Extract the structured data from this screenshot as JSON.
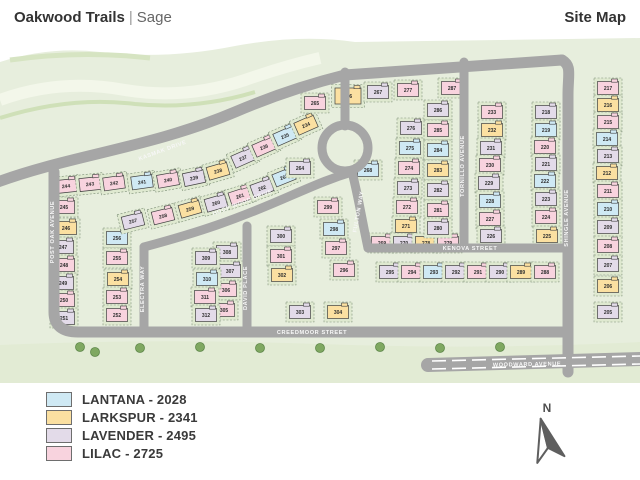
{
  "header": {
    "community": "Oakwood Trails",
    "pipe": "|",
    "collection": "Sage",
    "page_title": "Site Map"
  },
  "legend": {
    "items": [
      {
        "plan": "lantana",
        "label": "LANTANA - 2028",
        "color": "#cfe9f4"
      },
      {
        "plan": "larkspur",
        "label": "LARKSPUR - 2341",
        "color": "#fbe0a1"
      },
      {
        "plan": "lavender",
        "label": "LAVENDER - 2495",
        "color": "#e3dbe9"
      },
      {
        "plan": "lilac",
        "label": "LILAC - 2725",
        "color": "#f8d3de"
      }
    ]
  },
  "north_arrow": {
    "label": "N",
    "color": "#5f5f5f"
  },
  "map": {
    "plan_colors": {
      "lantana": "#cfe9f4",
      "larkspur": "#fbe0a1",
      "lavender": "#e3dbe9",
      "lilac": "#f8d3de"
    },
    "base_green": "#e7eedd",
    "parcel_green": "#dfe9d0",
    "road_gray": "#a6a6a6",
    "tree_green": "#7fa861",
    "streets": [
      {
        "name": "KASMAK DRIVE",
        "x": 163,
        "y": 152,
        "rot": -20
      },
      {
        "name": "POST OAK AVENUE",
        "x": 54,
        "y": 232,
        "rot": -90
      },
      {
        "name": "ELECTRA WAY",
        "x": 144,
        "y": 289,
        "rot": -90
      },
      {
        "name": "DAVID PLACE",
        "x": 247,
        "y": 288,
        "rot": -90
      },
      {
        "name": "HOOP WOOD DRIVE",
        "x": 243,
        "y": 204,
        "rot": -21
      },
      {
        "name": "FULTON WAY",
        "x": 360,
        "y": 212,
        "rot": -80
      },
      {
        "name": "TORNILLO AVENUE",
        "x": 464,
        "y": 166,
        "rot": -90
      },
      {
        "name": "SHINGLE AVENUE",
        "x": 568,
        "y": 218,
        "rot": -90
      },
      {
        "name": "KENOVA STREET",
        "x": 470,
        "y": 250,
        "rot": 0
      },
      {
        "name": "CREEDMOOR STREET",
        "x": 312,
        "y": 334,
        "rot": 0
      },
      {
        "name": "WOODWARD AVENUE",
        "x": 527,
        "y": 366,
        "rot": -1
      }
    ],
    "lots": [
      {
        "n": "244",
        "p": "lilac",
        "x": 66,
        "y": 186,
        "r": -6
      },
      {
        "n": "243",
        "p": "lilac",
        "x": 90,
        "y": 184,
        "r": -6
      },
      {
        "n": "242",
        "p": "lilac",
        "x": 114,
        "y": 183,
        "r": -8
      },
      {
        "n": "241",
        "p": "lantana",
        "x": 142,
        "y": 182,
        "r": -8
      },
      {
        "n": "240",
        "p": "lilac",
        "x": 168,
        "y": 180,
        "r": -10
      },
      {
        "n": "239",
        "p": "lavender",
        "x": 194,
        "y": 178,
        "r": -12
      },
      {
        "n": "238",
        "p": "larkspur",
        "x": 218,
        "y": 171,
        "r": -16
      },
      {
        "n": "237",
        "p": "lavender",
        "x": 243,
        "y": 158,
        "r": -24
      },
      {
        "n": "236",
        "p": "lilac",
        "x": 264,
        "y": 147,
        "r": -24
      },
      {
        "n": "235",
        "p": "lantana",
        "x": 285,
        "y": 136,
        "r": -24
      },
      {
        "n": "234",
        "p": "larkspur",
        "x": 306,
        "y": 125,
        "r": -24
      },
      {
        "n": "245",
        "p": "lilac",
        "x": 64,
        "y": 207
      },
      {
        "n": "246",
        "p": "larkspur",
        "x": 66,
        "y": 228
      },
      {
        "n": "247",
        "p": "lavender",
        "x": 63,
        "y": 247
      },
      {
        "n": "248",
        "p": "lilac",
        "x": 64,
        "y": 265
      },
      {
        "n": "249",
        "p": "lavender",
        "x": 63,
        "y": 283
      },
      {
        "n": "250",
        "p": "lilac",
        "x": 64,
        "y": 300
      },
      {
        "n": "251",
        "p": "lavender",
        "x": 64,
        "y": 318
      },
      {
        "n": "256",
        "p": "lantana",
        "x": 117,
        "y": 238
      },
      {
        "n": "255",
        "p": "lilac",
        "x": 117,
        "y": 258
      },
      {
        "n": "254",
        "p": "larkspur",
        "x": 118,
        "y": 279
      },
      {
        "n": "253",
        "p": "lilac",
        "x": 117,
        "y": 297
      },
      {
        "n": "252",
        "p": "lilac",
        "x": 117,
        "y": 315
      },
      {
        "n": "257",
        "p": "lavender",
        "x": 133,
        "y": 221,
        "r": -14
      },
      {
        "n": "258",
        "p": "lilac",
        "x": 163,
        "y": 216,
        "r": -14
      },
      {
        "n": "259",
        "p": "larkspur",
        "x": 190,
        "y": 209,
        "r": -16
      },
      {
        "n": "260",
        "p": "lavender",
        "x": 216,
        "y": 203,
        "r": -16
      },
      {
        "n": "261",
        "p": "lilac",
        "x": 240,
        "y": 196,
        "r": -18
      },
      {
        "n": "262",
        "p": "lavender",
        "x": 262,
        "y": 188,
        "r": -20
      },
      {
        "n": "263",
        "p": "lantana",
        "x": 284,
        "y": 177,
        "r": -22
      },
      {
        "n": "264",
        "p": "lavender",
        "x": 300,
        "y": 168
      },
      {
        "n": "265",
        "p": "lilac",
        "x": 315,
        "y": 103
      },
      {
        "n": "266",
        "p": "larkspur",
        "x": 348,
        "y": 96,
        "w": 26,
        "h": 16
      },
      {
        "n": "267",
        "p": "lavender",
        "x": 378,
        "y": 92
      },
      {
        "n": "268",
        "p": "lantana",
        "x": 368,
        "y": 170
      },
      {
        "n": "277",
        "p": "lilac",
        "x": 408,
        "y": 90
      },
      {
        "n": "287",
        "p": "lilac",
        "x": 452,
        "y": 88
      },
      {
        "n": "276",
        "p": "lavender",
        "x": 411,
        "y": 128
      },
      {
        "n": "275",
        "p": "lantana",
        "x": 410,
        "y": 148
      },
      {
        "n": "274",
        "p": "lilac",
        "x": 409,
        "y": 168
      },
      {
        "n": "273",
        "p": "lavender",
        "x": 408,
        "y": 188
      },
      {
        "n": "272",
        "p": "lilac",
        "x": 407,
        "y": 207
      },
      {
        "n": "271",
        "p": "larkspur",
        "x": 406,
        "y": 226
      },
      {
        "n": "269",
        "p": "lilac",
        "x": 382,
        "y": 243
      },
      {
        "n": "270",
        "p": "lavender",
        "x": 404,
        "y": 243
      },
      {
        "n": "278",
        "p": "larkspur",
        "x": 426,
        "y": 243
      },
      {
        "n": "279",
        "p": "lilac",
        "x": 448,
        "y": 243
      },
      {
        "n": "286",
        "p": "lavender",
        "x": 438,
        "y": 110
      },
      {
        "n": "285",
        "p": "lilac",
        "x": 438,
        "y": 130
      },
      {
        "n": "284",
        "p": "lantana",
        "x": 438,
        "y": 150
      },
      {
        "n": "283",
        "p": "larkspur",
        "x": 438,
        "y": 170
      },
      {
        "n": "282",
        "p": "lavender",
        "x": 438,
        "y": 190
      },
      {
        "n": "281",
        "p": "lilac",
        "x": 438,
        "y": 210
      },
      {
        "n": "280",
        "p": "lavender",
        "x": 438,
        "y": 228
      },
      {
        "n": "233",
        "p": "lilac",
        "x": 492,
        "y": 112
      },
      {
        "n": "232",
        "p": "larkspur",
        "x": 492,
        "y": 130
      },
      {
        "n": "231",
        "p": "lavender",
        "x": 491,
        "y": 148
      },
      {
        "n": "230",
        "p": "lilac",
        "x": 490,
        "y": 165
      },
      {
        "n": "229",
        "p": "lavender",
        "x": 489,
        "y": 183
      },
      {
        "n": "228",
        "p": "lantana",
        "x": 490,
        "y": 201
      },
      {
        "n": "227",
        "p": "lilac",
        "x": 490,
        "y": 219
      },
      {
        "n": "226",
        "p": "lavender",
        "x": 491,
        "y": 236
      },
      {
        "n": "218",
        "p": "lavender",
        "x": 546,
        "y": 112
      },
      {
        "n": "219",
        "p": "lantana",
        "x": 546,
        "y": 130
      },
      {
        "n": "220",
        "p": "lilac",
        "x": 545,
        "y": 147
      },
      {
        "n": "221",
        "p": "lavender",
        "x": 546,
        "y": 164
      },
      {
        "n": "222",
        "p": "lantana",
        "x": 545,
        "y": 181
      },
      {
        "n": "223",
        "p": "lavender",
        "x": 546,
        "y": 199
      },
      {
        "n": "224",
        "p": "lilac",
        "x": 546,
        "y": 217
      },
      {
        "n": "225",
        "p": "larkspur",
        "x": 547,
        "y": 236
      },
      {
        "n": "217",
        "p": "lilac",
        "x": 608,
        "y": 88
      },
      {
        "n": "216",
        "p": "larkspur",
        "x": 608,
        "y": 105
      },
      {
        "n": "215",
        "p": "lilac",
        "x": 608,
        "y": 122
      },
      {
        "n": "214",
        "p": "lantana",
        "x": 607,
        "y": 139
      },
      {
        "n": "213",
        "p": "lavender",
        "x": 608,
        "y": 156
      },
      {
        "n": "212",
        "p": "larkspur",
        "x": 607,
        "y": 173
      },
      {
        "n": "211",
        "p": "lilac",
        "x": 608,
        "y": 191
      },
      {
        "n": "210",
        "p": "lantana",
        "x": 608,
        "y": 209
      },
      {
        "n": "209",
        "p": "lavender",
        "x": 608,
        "y": 227
      },
      {
        "n": "208",
        "p": "lilac",
        "x": 608,
        "y": 246
      },
      {
        "n": "207",
        "p": "lavender",
        "x": 608,
        "y": 265
      },
      {
        "n": "206",
        "p": "larkspur",
        "x": 608,
        "y": 286
      },
      {
        "n": "205",
        "p": "lavender",
        "x": 608,
        "y": 312
      },
      {
        "n": "295",
        "p": "lavender",
        "x": 390,
        "y": 272
      },
      {
        "n": "294",
        "p": "lilac",
        "x": 412,
        "y": 272
      },
      {
        "n": "293",
        "p": "lantana",
        "x": 434,
        "y": 272
      },
      {
        "n": "292",
        "p": "lavender",
        "x": 456,
        "y": 272
      },
      {
        "n": "291",
        "p": "lilac",
        "x": 478,
        "y": 272
      },
      {
        "n": "290",
        "p": "lavender",
        "x": 500,
        "y": 272
      },
      {
        "n": "289",
        "p": "larkspur",
        "x": 521,
        "y": 272
      },
      {
        "n": "288",
        "p": "lilac",
        "x": 545,
        "y": 272
      },
      {
        "n": "299",
        "p": "lilac",
        "x": 328,
        "y": 207
      },
      {
        "n": "298",
        "p": "lantana",
        "x": 334,
        "y": 229
      },
      {
        "n": "297",
        "p": "lilac",
        "x": 336,
        "y": 248
      },
      {
        "n": "296",
        "p": "lilac",
        "x": 344,
        "y": 270
      },
      {
        "n": "300",
        "p": "lavender",
        "x": 281,
        "y": 236
      },
      {
        "n": "301",
        "p": "lilac",
        "x": 281,
        "y": 256
      },
      {
        "n": "302",
        "p": "larkspur",
        "x": 282,
        "y": 275
      },
      {
        "n": "303",
        "p": "lavender",
        "x": 300,
        "y": 312
      },
      {
        "n": "304",
        "p": "larkspur",
        "x": 338,
        "y": 312
      },
      {
        "n": "308",
        "p": "lavender",
        "x": 227,
        "y": 252
      },
      {
        "n": "307",
        "p": "lavender",
        "x": 230,
        "y": 271
      },
      {
        "n": "306",
        "p": "lilac",
        "x": 226,
        "y": 290
      },
      {
        "n": "305",
        "p": "lilac",
        "x": 224,
        "y": 310
      },
      {
        "n": "309",
        "p": "lavender",
        "x": 206,
        "y": 258
      },
      {
        "n": "310",
        "p": "lantana",
        "x": 207,
        "y": 279
      },
      {
        "n": "311",
        "p": "lilac",
        "x": 205,
        "y": 297
      },
      {
        "n": "312",
        "p": "lavender",
        "x": 206,
        "y": 315
      }
    ]
  }
}
